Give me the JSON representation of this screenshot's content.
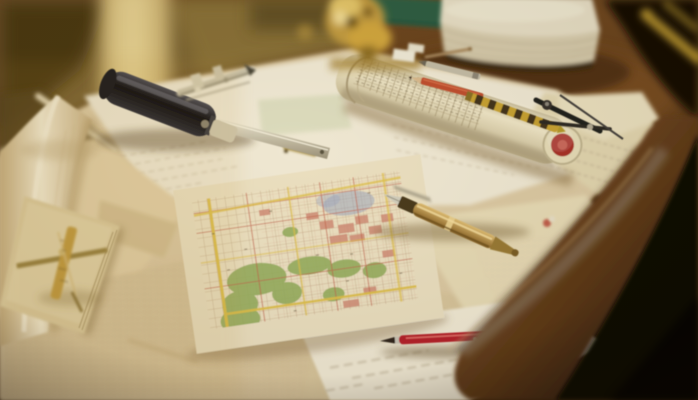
{
  "meta": {
    "type": "photograph",
    "subject": "Vintage city maps and drafting tools spread across a warm wooden drafting desk",
    "lighting": "golden window light from the upper left, dark room beyond the curved desk edge"
  },
  "palette": {
    "background_dark": "#0b0705",
    "window_glow": "#d9bf7c",
    "desk_wood": "#6e4a22",
    "desk_edge_dark": "#2a1708",
    "paper_cream": "#dcc9a2",
    "paper_white": "#efe7d1",
    "map_base": "#ece0c0",
    "map_road_yellow": "#dfc04a",
    "map_park_green": "#97ae5e",
    "map_block_pink": "#d08d76",
    "map_street_red": "#c2624a",
    "map_water_blue": "#96a2bc",
    "tool_black": "#23211c",
    "metal_silver": "#c9c1a8",
    "brass_gold": "#c29b3f",
    "tube_cap_red": "#a93127",
    "pen_red": "#b5242b",
    "pencil_yellow": "#c7a133",
    "pencil_orange": "#c04f2e",
    "notebook_green": "#2b5f45"
  },
  "objects": [
    {
      "id": "city-map",
      "label": "Hand-colored city street map with yellow roads, green parks, pink blocks and a blue district"
    },
    {
      "id": "rolled-plan-tube",
      "label": "Rolled plan printed with tables, capped with a red-ringed end"
    },
    {
      "id": "map-roller-tool",
      "label": "Black cylindrical map roller with a steel blade ruler"
    },
    {
      "id": "caliper",
      "label": "Steel caliper instrument on the blueprint sheet"
    },
    {
      "id": "brass-divider",
      "label": "Brass divider rule lying on a tan notepad"
    },
    {
      "id": "fountain-pen",
      "label": "Brass fountain pen with silver nib"
    },
    {
      "id": "red-pen",
      "label": "Red ballpoint pen with silver clip"
    },
    {
      "id": "pencils",
      "label": "Silver, orange and striped drafting pencils on the rolled plan"
    },
    {
      "id": "drafting-compass",
      "label": "Black drafting compass"
    },
    {
      "id": "book",
      "label": "Thick block of book pages at the back of the desk"
    },
    {
      "id": "green-notebook",
      "label": "Green notebook behind the brass instrument"
    },
    {
      "id": "brass-instrument",
      "label": "Ornate gold brass instrument, out of focus"
    },
    {
      "id": "yellow-pencil",
      "label": "Blurred yellow pencil at the top-right desk edge"
    },
    {
      "id": "curled-sheet",
      "label": "Curled map sheet standing up at the left edge"
    }
  ]
}
